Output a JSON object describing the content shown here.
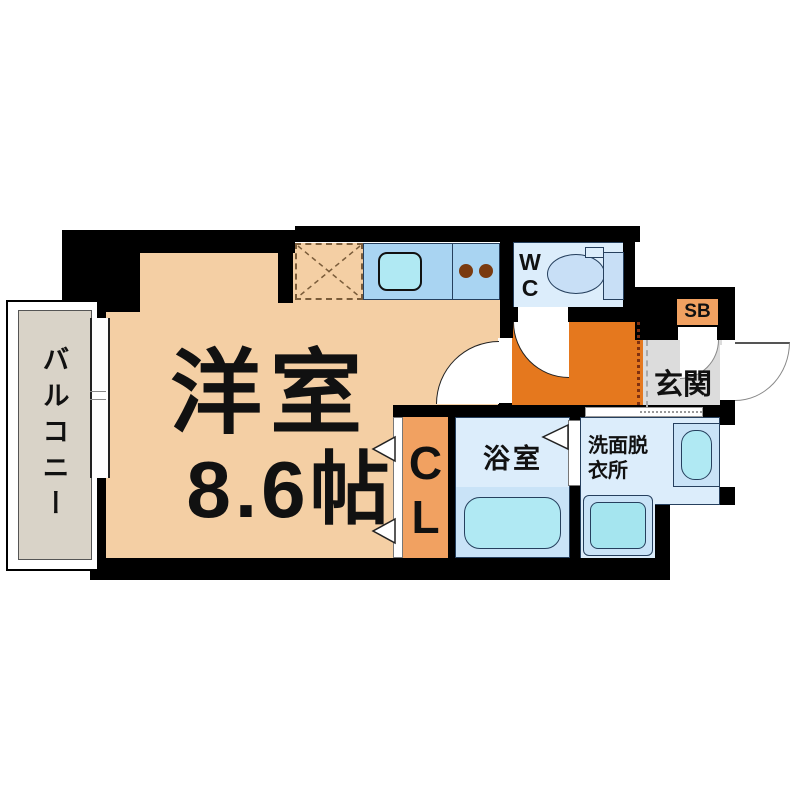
{
  "floorplan": {
    "rooms": {
      "balcony": {
        "label": "バルコニー"
      },
      "western_room": {
        "label": "洋室",
        "size": "8.6帖"
      },
      "wc": {
        "label": "WC",
        "line1": "W",
        "line2": "C"
      },
      "shoe_box": {
        "label": "SB"
      },
      "entrance": {
        "label": "玄関"
      },
      "closet": {
        "label": "CL",
        "line1": "C",
        "line2": "L"
      },
      "bathroom": {
        "label": "浴室"
      },
      "washroom": {
        "label": "洗面脱衣所",
        "line1": "洗面脱",
        "line2": "衣所"
      }
    },
    "fixtures": {
      "kitchen_sink": "sink",
      "stove_burners": 2,
      "refrigerator_space": "dashed-x-square",
      "toilet": "toilet",
      "bathtub": "bathtub",
      "washing_machine": "washing-machine",
      "vanity_sink": "sink-unit"
    },
    "colors": {
      "wall": "#000000",
      "main_room": "#F4CFA4",
      "hallway": "#E5781E",
      "accent_orange": "#F1A161",
      "room_blue": "#DCEDFB",
      "counter_blue": "#A9D4F2",
      "fixture_blue": "#C9E3F7",
      "fixture_cyan": "#B0E9F3",
      "washer_cyan": "#A5E5EF",
      "toilet_blue": "#C8DFF6",
      "entrance_gray": "#DCDCDC",
      "balcony_gray": "#D9D3C8",
      "burner_brown": "#7A3A10"
    }
  }
}
